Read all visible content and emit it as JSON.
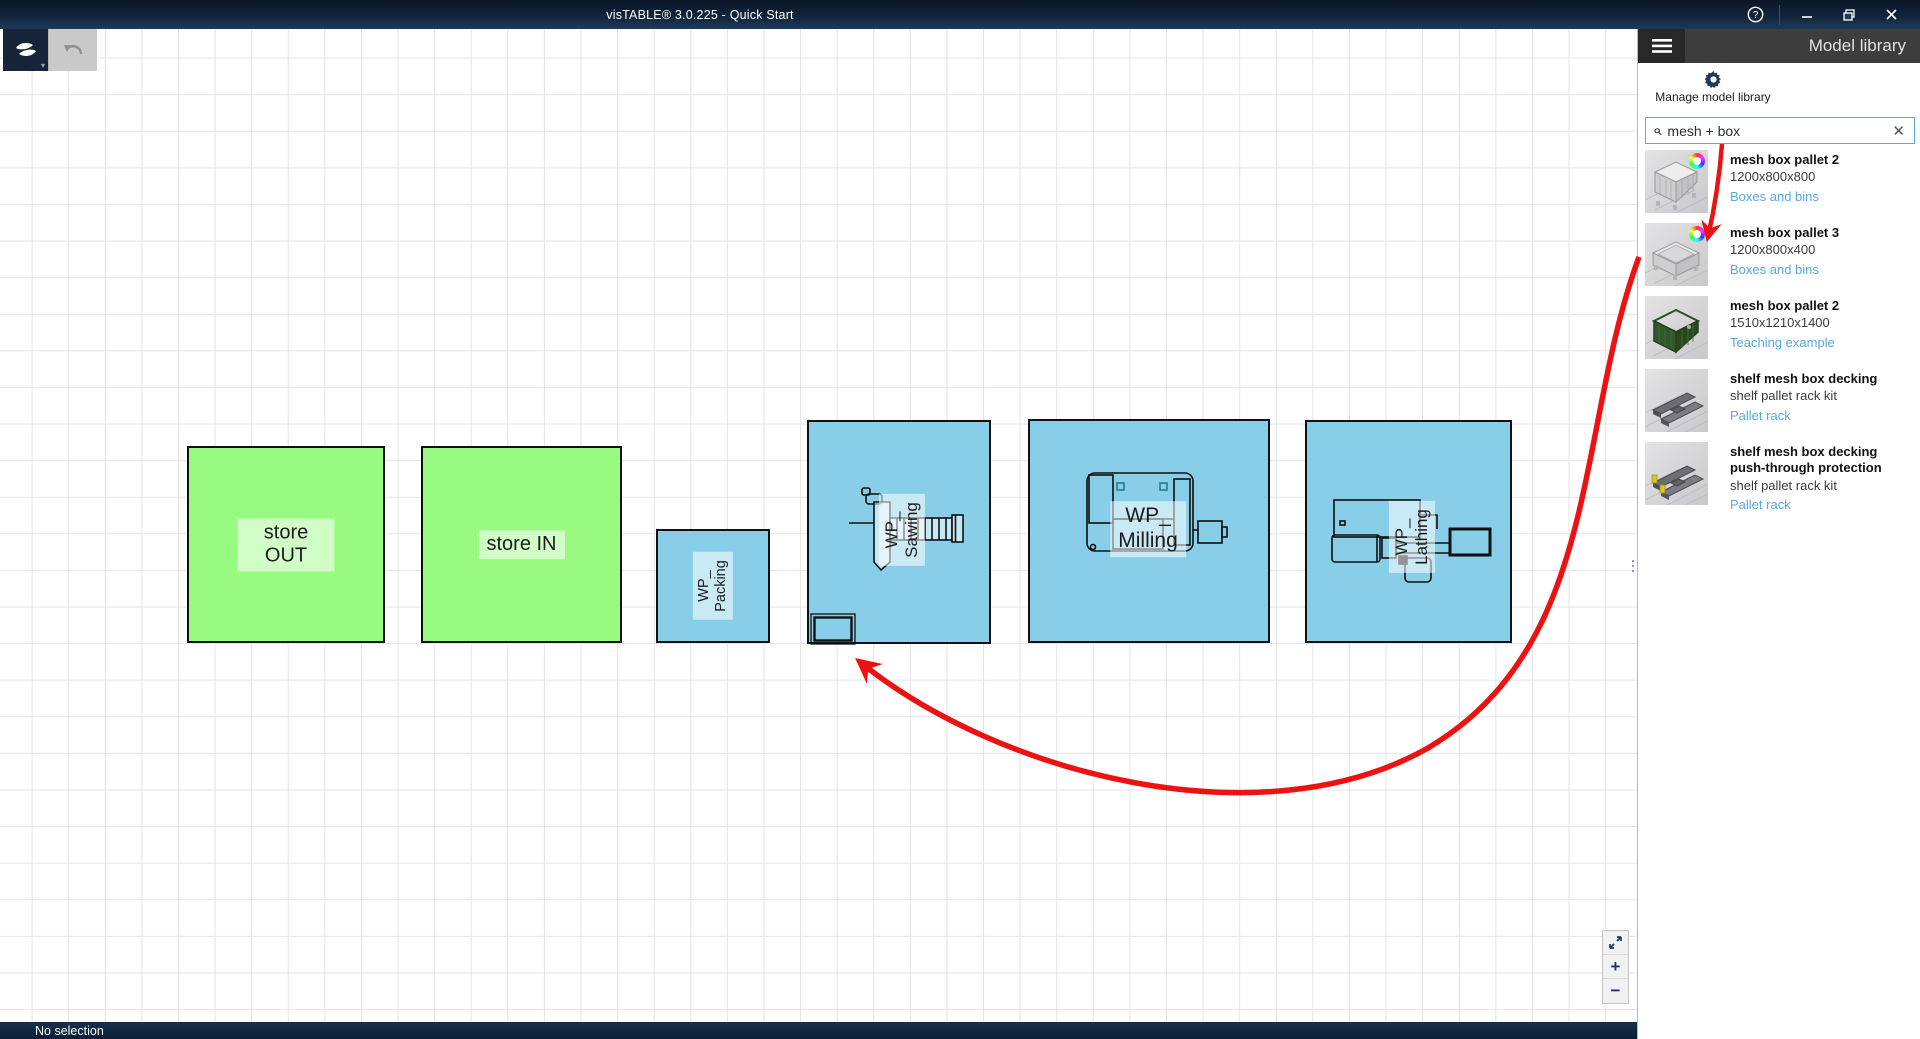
{
  "window": {
    "title": "visTABLE®  3.0.225 - Quick Start",
    "status": "No selection"
  },
  "colors": {
    "accent_red": "#ed1212",
    "link_blue": "#57a9de",
    "area_green": "#99fa81",
    "area_blue": "#88cee9",
    "titlebar_navy": "#11243b"
  },
  "toolbar": {
    "logo_button": "app-menu",
    "undo_button": "undo"
  },
  "sidebar": {
    "header": "Model library",
    "manage_label": "Manage model library",
    "search": {
      "value": "mesh + box",
      "clear_label": "✕"
    },
    "items": [
      {
        "title": "mesh box pallet 2",
        "subtitle": "1200x800x800",
        "category": "Boxes and bins"
      },
      {
        "title": "mesh box pallet 3",
        "subtitle": "1200x800x400",
        "category": "Boxes and bins"
      },
      {
        "title": "mesh box pallet 2",
        "subtitle": "1510x1210x1400",
        "category": "Teaching example"
      },
      {
        "title": "shelf mesh box decking",
        "subtitle": "shelf pallet rack kit",
        "category": "Pallet rack"
      },
      {
        "title": "shelf mesh box decking push-through protection",
        "subtitle": "shelf pallet rack kit",
        "category": "Pallet rack"
      }
    ]
  },
  "canvas": {
    "areas": [
      {
        "label": "store OUT"
      },
      {
        "label": "store IN"
      },
      {
        "label": "WP_\nPacking"
      },
      {
        "label": "WP_\nSawing"
      },
      {
        "label": "WP_\nMilling"
      },
      {
        "label": "WP_\nLathing"
      }
    ],
    "zoom_controls": {
      "zoom_in": "+",
      "zoom_out": "−"
    }
  }
}
